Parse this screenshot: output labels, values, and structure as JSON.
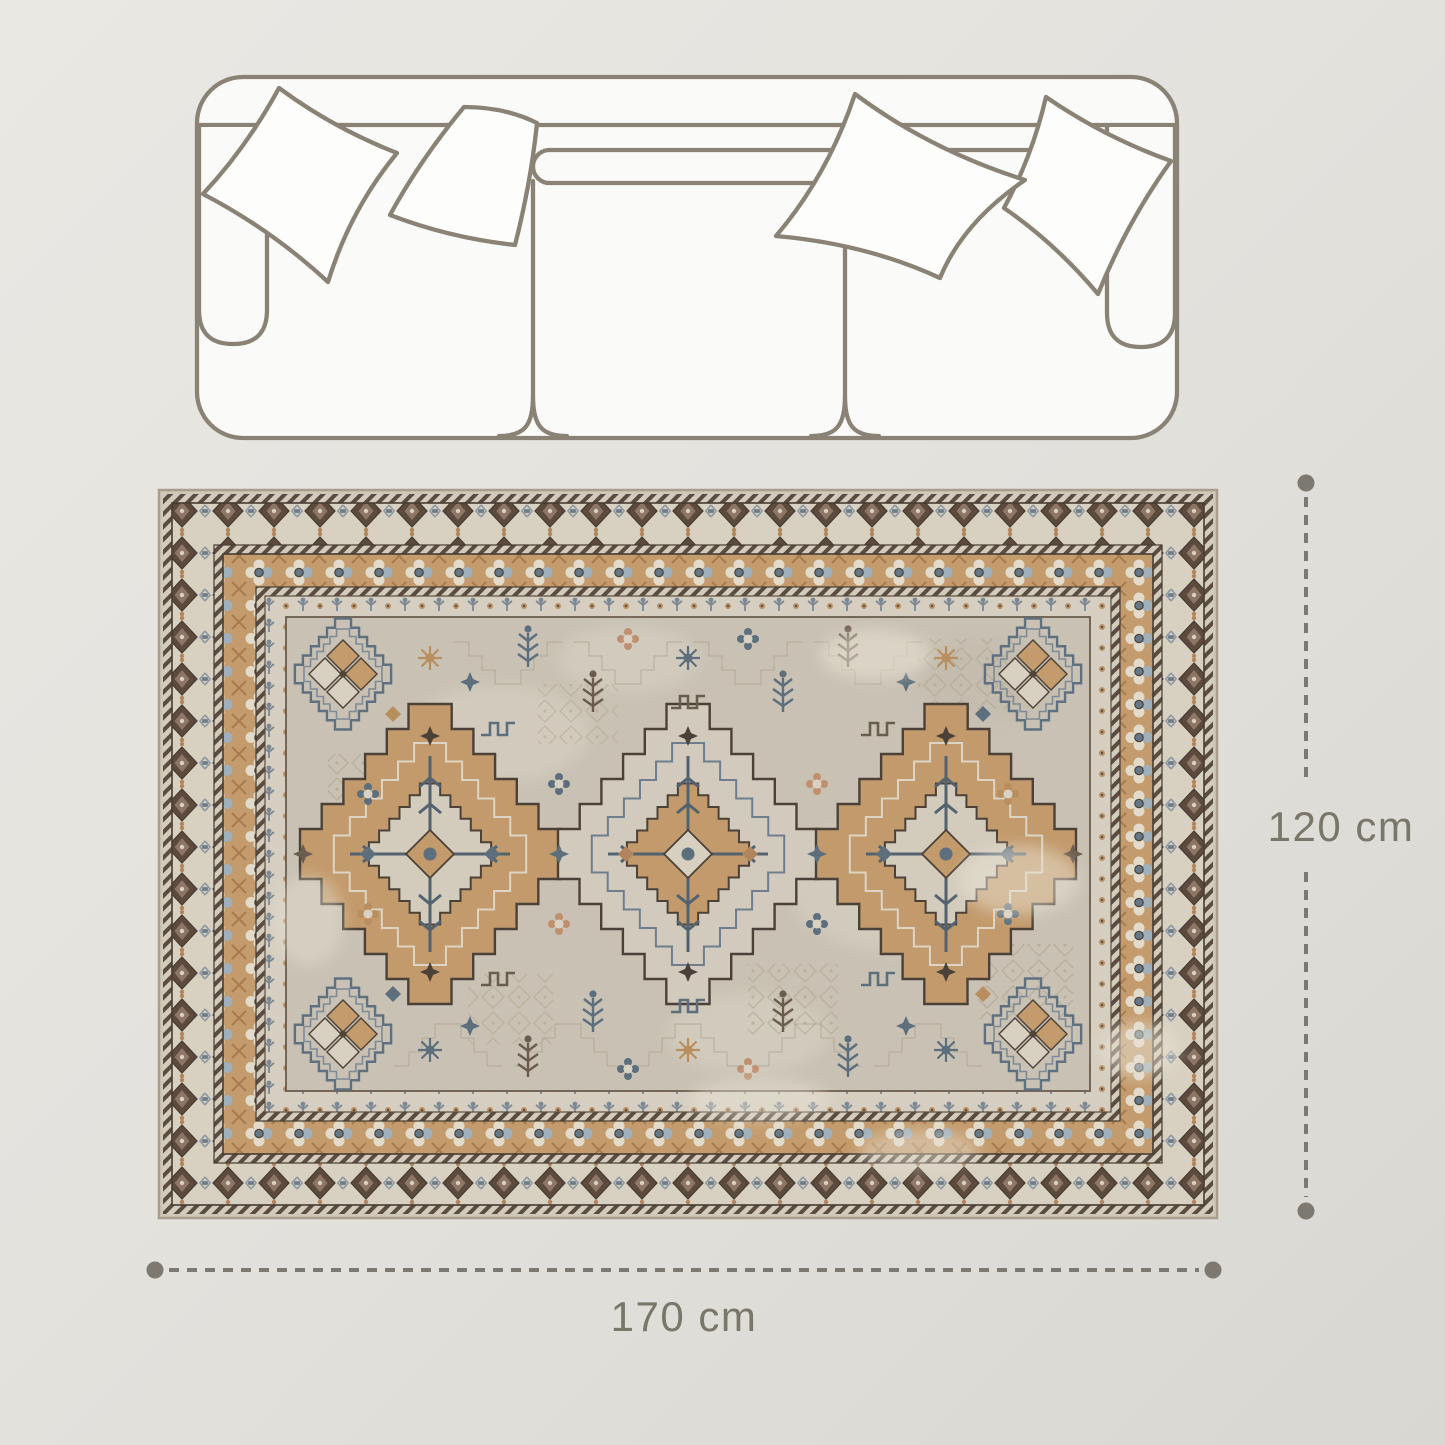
{
  "page": {
    "type": "product-dimension-diagram",
    "background_top": "#eae8e3",
    "background_bottom": "#d9d7d1"
  },
  "dimensions": {
    "height_label": "120 cm",
    "width_label": "170 cm",
    "line_color": "#7d7970",
    "text_color": "#7a7669"
  },
  "sofa": {
    "icon": "sofa-top-view-icon",
    "outline_color": "#8a8375",
    "fill_color": "#fafaf8",
    "pillow_count": 4
  },
  "rug": {
    "icon": "oriental-rug-image",
    "field_color": "#c9c2b4",
    "border_cream": "#d8d0c0",
    "border_tan": "#c39b6c",
    "accent_slate": "#5f7080",
    "accent_brown": "#53443a",
    "medallion_count": 3
  }
}
